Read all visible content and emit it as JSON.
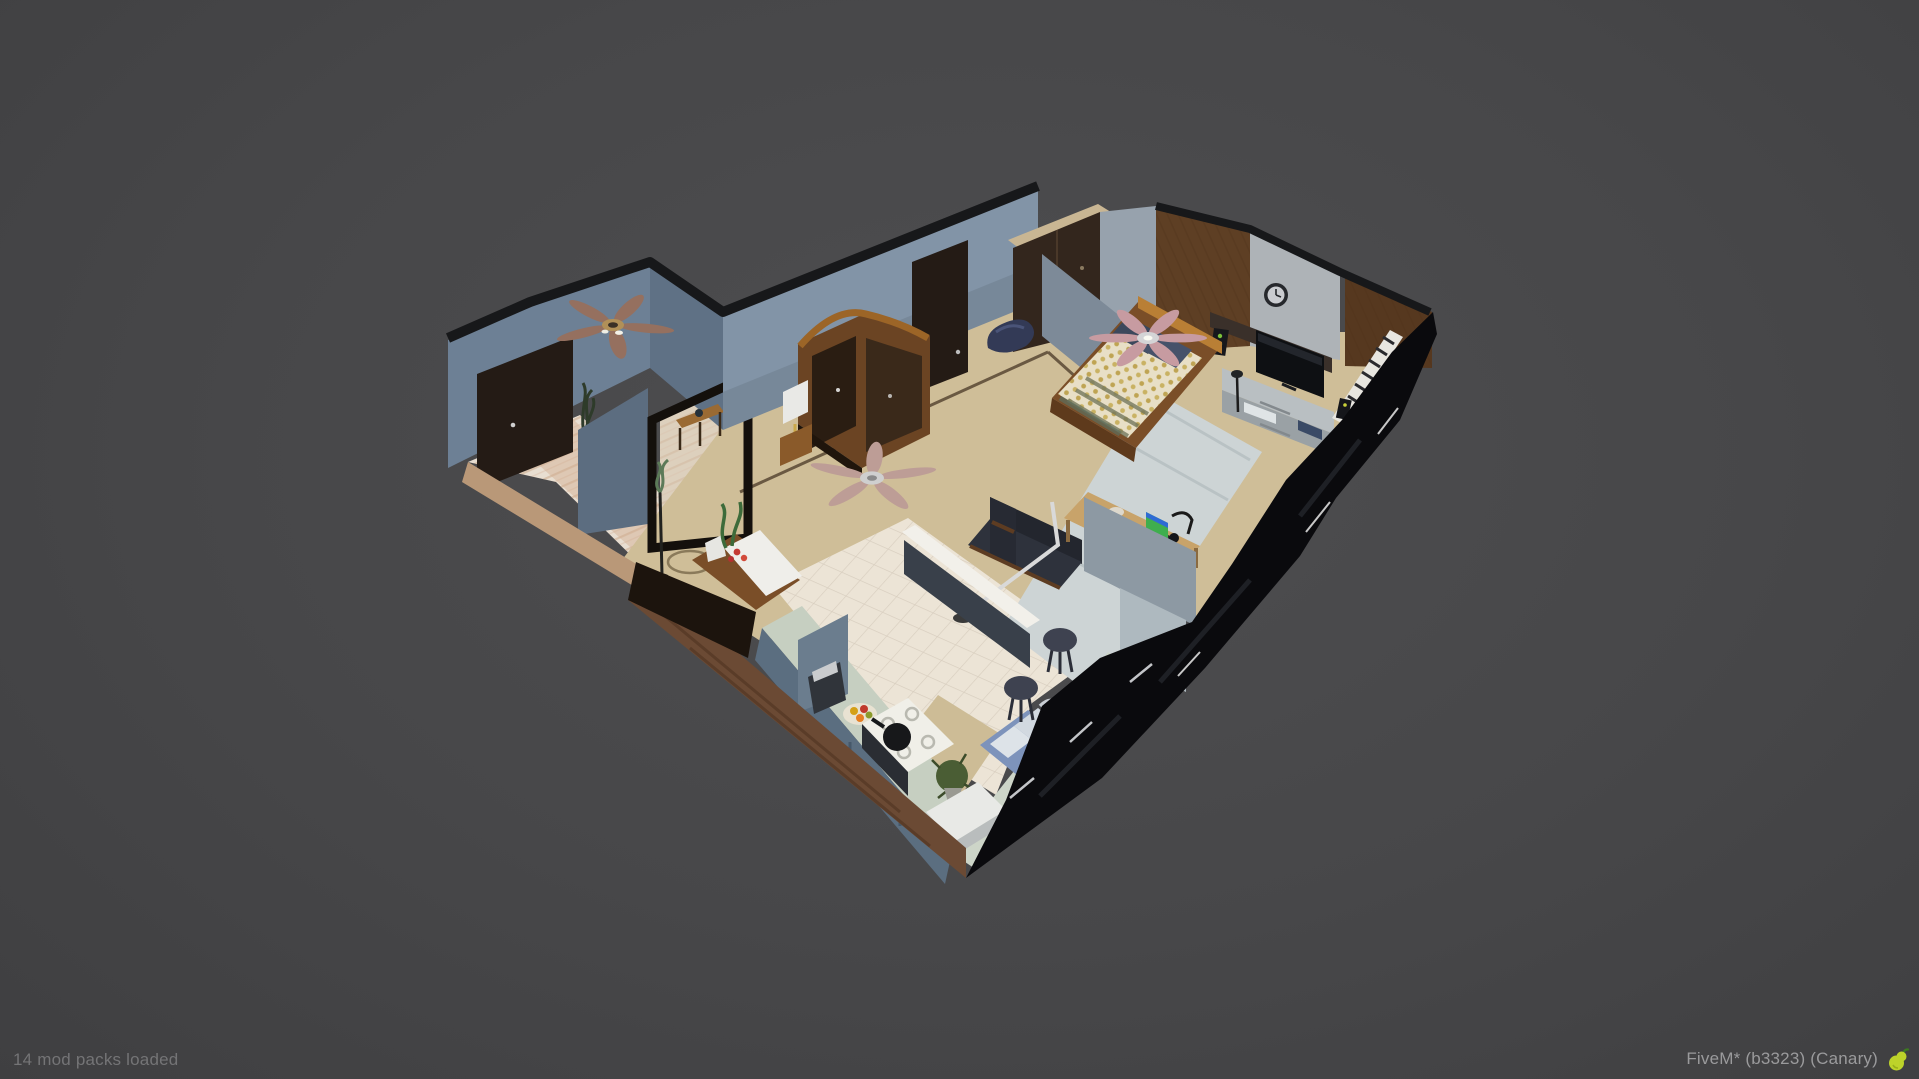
{
  "status_bar": {
    "left_text": "14 mod packs loaded",
    "right_text": "FiveM* (b3323) (Canary)",
    "left_text_color": "#747476",
    "right_text_color": "#9a9a9c",
    "pear_icon": {
      "body": "#bdd32a",
      "stem": "#3c7a1f"
    }
  },
  "scene": {
    "type": "isometric-apartment-dollhouse-3d-view",
    "rooms": [
      "entry-hall",
      "living-room",
      "bedroom",
      "kitchen",
      "office-nook"
    ],
    "palette": {
      "background": "#474749",
      "wall_blue_gray": "#7b8ca0",
      "wall_cut_edge": "#17181a",
      "carpet_tan": "#d3c29c",
      "kitchen_tile": "#ece4d6",
      "entry_wood": "#e8ded1",
      "exterior_dark": "#0a0a0d",
      "exterior_wood": "#6b4a34",
      "bed_duvet": "#e8dfc6",
      "duvet_dots": "#b89a3e",
      "fan_blade_pink": "#c79ba1",
      "counter_sage": "#c9d2c4",
      "rug_light": "#d7dcdb"
    }
  }
}
